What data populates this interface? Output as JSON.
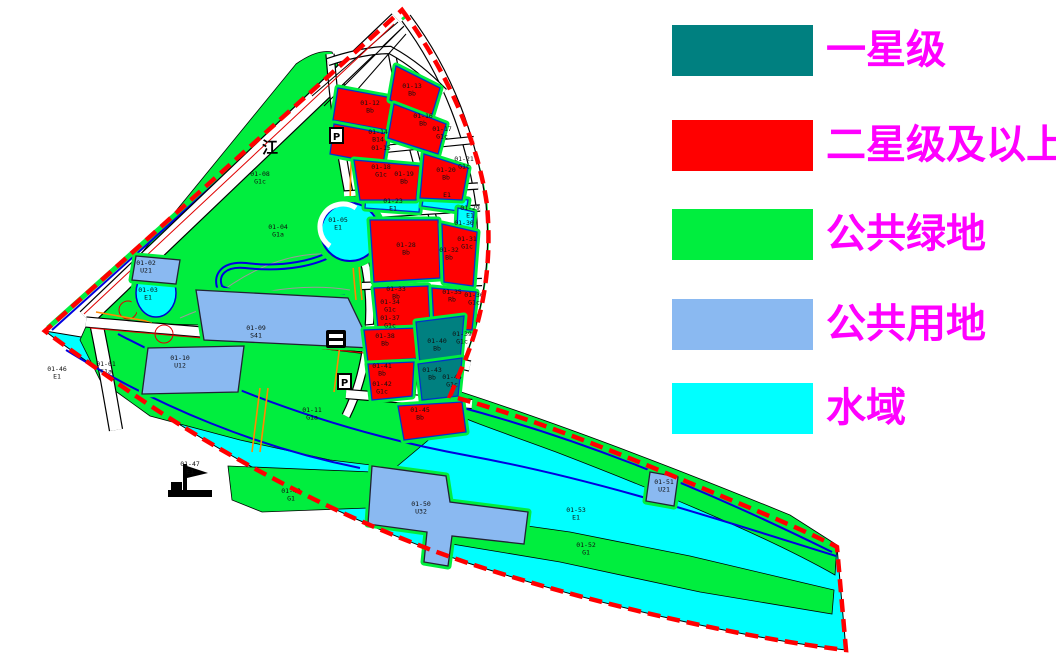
{
  "colors": {
    "one_star": "#008080",
    "two_star_plus": "#FF0000",
    "public_green": "#00EE3E",
    "public_land": "#8AB9F1",
    "water": "#00FFFF",
    "legend_text": "#FF00FF",
    "boundary": "#FF0000"
  },
  "legend": {
    "items": [
      {
        "name": "one-star",
        "label": "一星级",
        "color": "#008080"
      },
      {
        "name": "two-star-plus",
        "label": "二星级及以上",
        "color": "#FF0000"
      },
      {
        "name": "public-green",
        "label": "公共绿地",
        "color": "#00EE3E"
      },
      {
        "name": "public-land",
        "label": "公共用地",
        "color": "#8AB9F1"
      },
      {
        "name": "water",
        "label": "水域",
        "color": "#00FFFF"
      }
    ]
  },
  "map": {
    "annotations": {
      "river_char": "江",
      "parking": "P"
    },
    "parcels": [
      {
        "id": "01-01",
        "code": "G1a",
        "x": 106,
        "y": 366
      },
      {
        "id": "01-02",
        "code": "U21",
        "x": 146,
        "y": 265
      },
      {
        "id": "01-03",
        "code": "E1",
        "x": 148,
        "y": 292
      },
      {
        "id": "01-04",
        "code": "G1a",
        "x": 278,
        "y": 229
      },
      {
        "id": "01-05",
        "code": "E1",
        "x": 338,
        "y": 222
      },
      {
        "id": "01-08",
        "code": "G1c",
        "x": 260,
        "y": 176
      },
      {
        "id": "01-09",
        "code": "S41",
        "x": 256,
        "y": 330
      },
      {
        "id": "01-10",
        "code": "U12",
        "x": 180,
        "y": 360
      },
      {
        "id": "01-11",
        "code": "G1a",
        "x": 312,
        "y": 412
      },
      {
        "id": "01-12",
        "code": "Bb",
        "x": 370,
        "y": 105
      },
      {
        "id": "01-13",
        "code": "Bb",
        "x": 412,
        "y": 88
      },
      {
        "id": "01-14",
        "code": "B14",
        "x": 378,
        "y": 134
      },
      {
        "id": "01-15",
        "code": "",
        "x": 381,
        "y": 150
      },
      {
        "id": "01-16",
        "code": "Bb",
        "x": 423,
        "y": 118
      },
      {
        "id": "01-17",
        "code": "G1c",
        "x": 442,
        "y": 131
      },
      {
        "id": "01-18",
        "code": "G1c",
        "x": 381,
        "y": 169
      },
      {
        "id": "01-19",
        "code": "Bb",
        "x": 404,
        "y": 176
      },
      {
        "id": "01-20",
        "code": "Bb",
        "x": 446,
        "y": 172
      },
      {
        "id": "01-21",
        "code": "G1c",
        "x": 464,
        "y": 161
      },
      {
        "id": "01-23",
        "code": "E1",
        "x": 393,
        "y": 203
      },
      {
        "id": "E1",
        "code": "",
        "x": 447,
        "y": 197
      },
      {
        "id": "01-28",
        "code": "Bb",
        "x": 406,
        "y": 247
      },
      {
        "id": "01-29",
        "code": "E1",
        "x": 470,
        "y": 210
      },
      {
        "id": "01-30",
        "code": "",
        "x": 464,
        "y": 225
      },
      {
        "id": "01-31",
        "code": "G1c",
        "x": 467,
        "y": 241
      },
      {
        "id": "01-32",
        "code": "Bb",
        "x": 449,
        "y": 252
      },
      {
        "id": "01-33",
        "code": "Bb",
        "x": 396,
        "y": 291
      },
      {
        "id": "01-34",
        "code": "G1c",
        "x": 390,
        "y": 304
      },
      {
        "id": "01-35",
        "code": "Rb",
        "x": 452,
        "y": 294
      },
      {
        "id": "01-36",
        "code": "G1c",
        "x": 474,
        "y": 297
      },
      {
        "id": "01-37",
        "code": "G1c",
        "x": 390,
        "y": 320
      },
      {
        "id": "01-38",
        "code": "Bb",
        "x": 385,
        "y": 338
      },
      {
        "id": "01-39",
        "code": "G1c",
        "x": 462,
        "y": 336
      },
      {
        "id": "01-40",
        "code": "Bb",
        "x": 437,
        "y": 343
      },
      {
        "id": "01-41",
        "code": "Bb",
        "x": 382,
        "y": 368
      },
      {
        "id": "01-42",
        "code": "G1c",
        "x": 382,
        "y": 386
      },
      {
        "id": "01-43",
        "code": "Bb",
        "x": 432,
        "y": 372
      },
      {
        "id": "01-44",
        "code": "G1c",
        "x": 452,
        "y": 379
      },
      {
        "id": "01-45",
        "code": "Bb",
        "x": 420,
        "y": 412
      },
      {
        "id": "01-46",
        "code": "E1",
        "x": 57,
        "y": 371
      },
      {
        "id": "01-47",
        "code": "E1",
        "x": 190,
        "y": 466
      },
      {
        "id": "01-49",
        "code": "G1",
        "x": 291,
        "y": 493
      },
      {
        "id": "01-50",
        "code": "U32",
        "x": 421,
        "y": 506
      },
      {
        "id": "01-51",
        "code": "U21",
        "x": 664,
        "y": 484
      },
      {
        "id": "01-52",
        "code": "G1",
        "x": 586,
        "y": 547
      },
      {
        "id": "01-53",
        "code": "E1",
        "x": 576,
        "y": 512
      }
    ]
  }
}
